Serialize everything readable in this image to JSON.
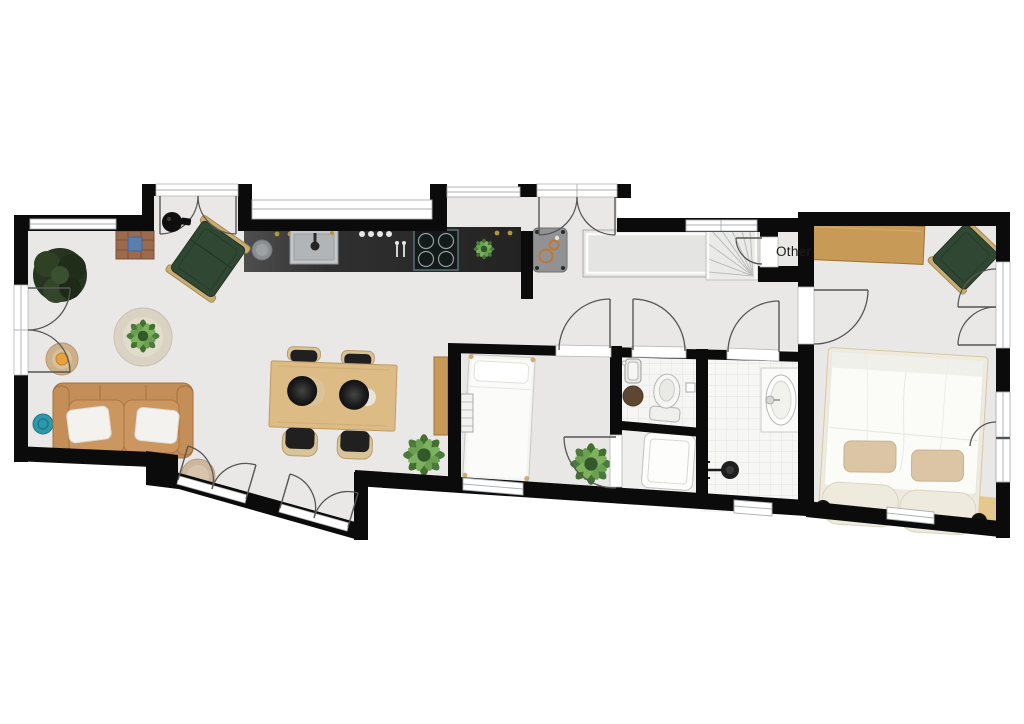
{
  "floorplan": {
    "labels": {
      "other_room": "Other"
    },
    "colors": {
      "background": "#ffffff",
      "wall": "#0b0b0b",
      "floor": "#e9e8e6",
      "tile_floor": "#f5f5f3",
      "kitchen_counter_dark": "#2e2e2e",
      "sideboard_light": "#e4e4e2",
      "wood_desk": "#c79a57",
      "wood_table": "#dcbb85",
      "sofa_leather": "#c48e58",
      "green_chair": "#2f4733",
      "chair_trim": "#c9ad74",
      "pillow_white": "#f3f2ee",
      "pillow_beige": "#dbc5a4",
      "cushion_cream": "#efeade",
      "stool_teal": "#2d97ac",
      "rug_beige": "#dad3c3",
      "rug_brown": "#5d4733",
      "plant_green": "#4c7a3d",
      "tree_dark": "#26351f",
      "appliance_gray": "#909294",
      "door_arc": "#565656"
    },
    "rooms": [
      "living-room",
      "kitchen",
      "dining-area",
      "entry-vestibule",
      "porch-doorway",
      "hallway",
      "staircase",
      "other-closet",
      "single-bedroom",
      "wc",
      "laundry",
      "bathroom",
      "master-bedroom"
    ],
    "furniture": {
      "living_room": [
        "sofa",
        "throw-pillows",
        "green-bench",
        "tree-plant",
        "round-rug",
        "potted-plant",
        "side-table-lamp",
        "teal-stool",
        "brick-side-table",
        "pendant-lamp",
        "small-rug"
      ],
      "kitchen": [
        "dark-counter",
        "sink",
        "induction-hob",
        "cooking-pot",
        "utensils",
        "herbs",
        "appliance"
      ],
      "dining_area": [
        "dining-table",
        "dining-chairs",
        "plant",
        "wood-console"
      ],
      "hallway": [
        "sideboard",
        "winder-stairs"
      ],
      "single_bedroom": [
        "single-bed",
        "radiator",
        "plant"
      ],
      "wc": [
        "toilet",
        "hand-basin",
        "round-rug",
        "paper-holder"
      ],
      "laundry": [
        "washing-machine"
      ],
      "bathroom": [
        "washbasin",
        "shower",
        "towel-rail"
      ],
      "master_bedroom": [
        "double-bed",
        "pillows",
        "headboard-cushions",
        "desk",
        "desk-chair",
        "ball-lamps",
        "floor-mat"
      ]
    }
  }
}
